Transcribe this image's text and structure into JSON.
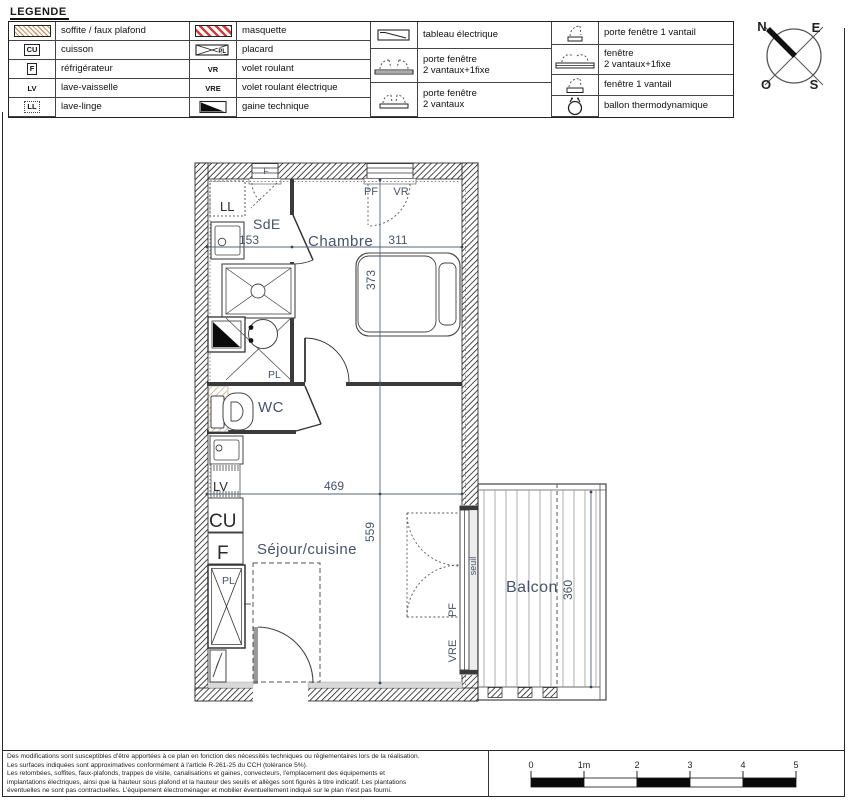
{
  "colors": {
    "label_slate": "#46536a",
    "soffite_tan": "#c69a6b",
    "masquette_red": "#cc4040",
    "wall_dark": "#222222"
  },
  "legend": {
    "title": "LEGENDE",
    "groups": [
      {
        "items": [
          {
            "icon": "soffite-hatch-icon",
            "label": "soffite / faux plafond"
          },
          {
            "icon": "cuisson-icon",
            "symbol_text": "CU",
            "label": "cuisson"
          },
          {
            "icon": "refrigerateur-icon",
            "symbol_text": "F",
            "label": "réfrigérateur"
          },
          {
            "icon": "lave-vaisselle-icon",
            "symbol_text": "LV",
            "label": "lave-vaisselle"
          },
          {
            "icon": "lave-linge-icon",
            "symbol_text": "LL",
            "label": "lave-linge"
          }
        ]
      },
      {
        "items": [
          {
            "icon": "masquette-hatch-icon",
            "label": "masquette"
          },
          {
            "icon": "placard-icon",
            "symbol_text": "PL",
            "label": "placard"
          },
          {
            "icon": "volet-roulant-icon",
            "symbol_text": "VR",
            "label": "volet roulant"
          },
          {
            "icon": "volet-roulant-electrique-icon",
            "symbol_text": "VRE",
            "label": "volet roulant électrique"
          },
          {
            "icon": "gaine-technique-icon",
            "label": "gaine technique"
          }
        ]
      },
      {
        "items": [
          {
            "icon": "tableau-electrique-icon",
            "label": "tableau électrique"
          },
          {
            "icon": "porte-fenetre-2v1f-icon",
            "label": "porte fenêtre\n2 vantaux+1fixe"
          },
          {
            "icon": "porte-fenetre-2v-icon",
            "label": "porte fenêtre\n2 vantaux"
          }
        ]
      },
      {
        "items": [
          {
            "icon": "porte-fenetre-1v-icon",
            "label": "porte fenêtre 1 vantail"
          },
          {
            "icon": "fenetre-2v1f-icon",
            "label": "fenêtre\n2 vantaux+1fixe"
          },
          {
            "icon": "fenetre-1v-icon",
            "label": "fenêtre 1 vantail"
          },
          {
            "icon": "ballon-thermodynamique-icon",
            "label": "ballon thermodynamique"
          }
        ]
      }
    ]
  },
  "compass": {
    "n": "N",
    "e": "E",
    "s": "S",
    "o": "O"
  },
  "plan": {
    "rooms": {
      "sde": "SdE",
      "chambre": "Chambre",
      "wc": "WC",
      "sejour": "Séjour/cuisine",
      "balcon": "Balcon"
    },
    "appliances": {
      "ll": "LL",
      "lv": "LV",
      "cu": "CU",
      "f": "F",
      "pl_bath": "PL",
      "pl_sejour": "PL"
    },
    "dims": {
      "sde_w": "153",
      "chambre_w": "311",
      "chambre_h": "373",
      "sejour_w": "469",
      "sejour_h": "559",
      "balcon_h": "360"
    },
    "tags": {
      "window_f": "F",
      "pf_chambre": "PF",
      "vr_chambre": "VR",
      "pf_sejour": "PF",
      "vre_sejour": "VRE",
      "seuil": "seuil"
    }
  },
  "footer": {
    "disclaimer": [
      "Des modifications sont susceptibles d'être apportées à ce plan en fonction des nécessités techniques ou règlementaires lors de la réalisation.",
      "Les surfaces indiquées sont approximatives conformément à l'article R-261-25 du CCH (tolérance 5%).",
      "Les retombées, soffites, faux-plafonds, trappes de visite, canalisations et gaines, convecteurs, l'emplacement des équipements et",
      "implantations électriques, ainsi que la hauteur sous plafond et la hauteur des seuils et allèges sont figurés à titre indicatif. Les plantations",
      "éventuelles ne sont pas contractuelles. L'équipement électroménager et mobilier éventuellement indiqué sur le plan n'est pas fourni."
    ],
    "scale": {
      "labels": [
        "0",
        "1m",
        "2",
        "3",
        "4",
        "5"
      ]
    }
  }
}
